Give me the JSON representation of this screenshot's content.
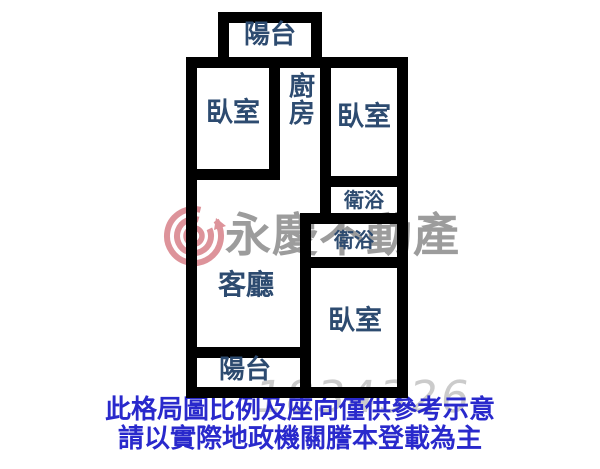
{
  "floorplan": {
    "rooms": {
      "balcony_top": "陽台",
      "bedroom_left": "臥室",
      "kitchen": "廚房",
      "bedroom_right": "臥室",
      "bath_upper": "衛浴",
      "bath_lower": "衛浴",
      "living_room": "客廳",
      "balcony_bottom": "陽台",
      "bedroom_bottom": "臥室"
    },
    "wall_color": "#000000",
    "label_color": "#2d4b70"
  },
  "watermark": {
    "brand": "永慶不動產",
    "number": "1834326",
    "logo_icon": "spiral-g-logo",
    "brand_color": "#808080",
    "logo_color": "#c23c48"
  },
  "disclaimer": {
    "line1": "此格局圖比例及座向僅供參考示意",
    "line2": "請以實際地政機關謄本登載為主",
    "color": "#2929cc"
  }
}
